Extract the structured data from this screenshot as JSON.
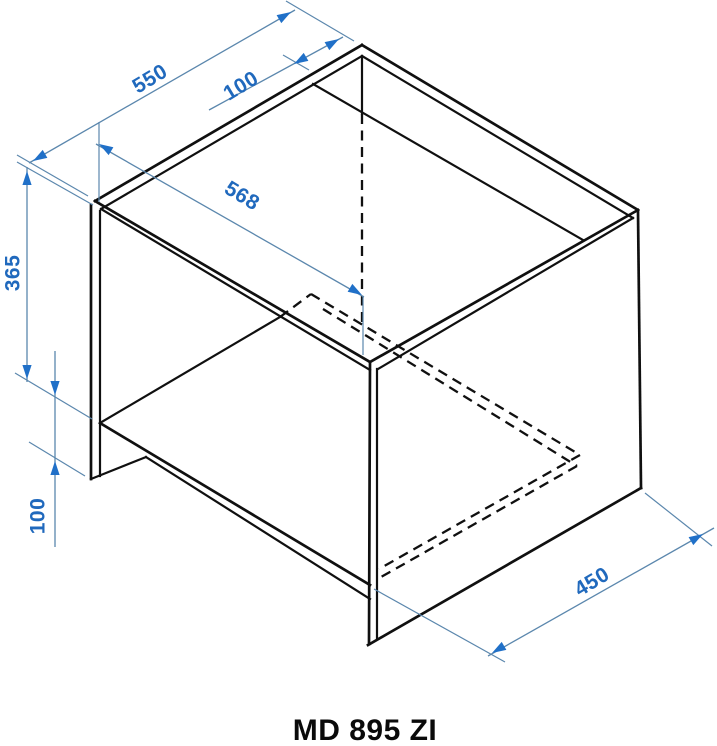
{
  "title": {
    "model": "MD 895 ZI"
  },
  "drawing": {
    "type": "isometric cabinet technical drawing",
    "unit": "mm",
    "colors": {
      "dimension_line": "#5b87ad",
      "dimension_accent": "#2070c8",
      "edge": "#101010",
      "background": "#ffffff"
    },
    "dimensions": {
      "top_depth": {
        "label": "550"
      },
      "top_rail_width": {
        "label": "100"
      },
      "interior_width": {
        "label": "568"
      },
      "niche_height": {
        "label": "365"
      },
      "base_height": {
        "label": "100"
      },
      "bottom_depth": {
        "label": "450"
      }
    }
  }
}
